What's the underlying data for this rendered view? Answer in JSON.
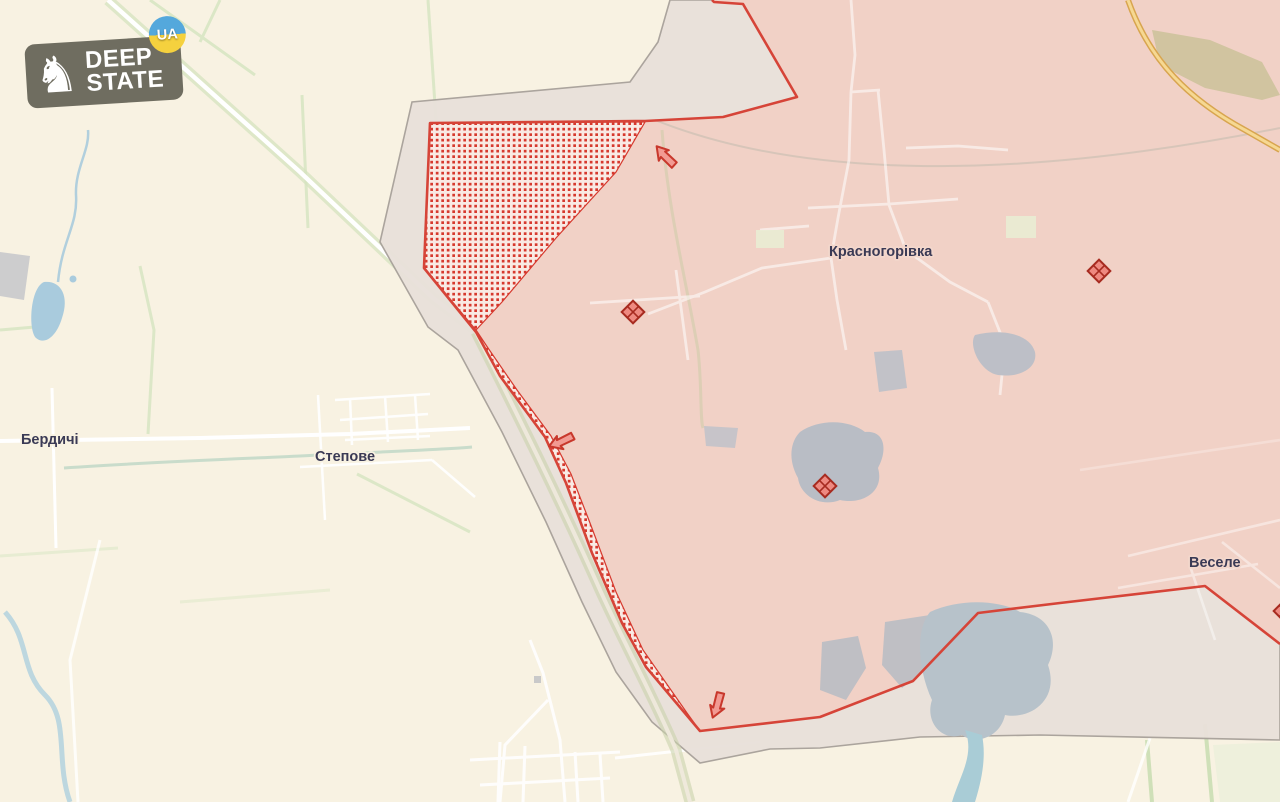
{
  "logo": {
    "line1": "DEEP",
    "line2": "STATE",
    "badge": "UA",
    "knight_icon": "♞"
  },
  "map": {
    "labels": {
      "berdychi": "Бердичі",
      "stepove": "Степове",
      "krasnohorivka": "Красногорівка",
      "vesele": "Веселе"
    },
    "markers": {
      "diamonds": [
        {
          "x": 633,
          "y": 312
        },
        {
          "x": 825,
          "y": 486
        },
        {
          "x": 1099,
          "y": 271
        },
        {
          "x": 1285,
          "y": 611
        }
      ],
      "arrows": [
        {
          "x": 665,
          "y": 157,
          "angle": -38,
          "direction": "northwest"
        },
        {
          "x": 562,
          "y": 442,
          "angle": 252,
          "direction": "west"
        },
        {
          "x": 718,
          "y": 705,
          "angle": 203,
          "direction": "south"
        }
      ]
    },
    "colors": {
      "free_fill": "#f8f2e2",
      "occupied_fill": "#f1d1c6",
      "contested_fill": "#e9e1da",
      "contested_border": "#a9a29b",
      "frontline": "#d64438",
      "advance_dot": "#d6392e",
      "advance_bg": "#f9eae4",
      "water_blue": "#a9cbdd",
      "pond_gray": "#b9bdc5",
      "field_green": "#d8e6c4",
      "road_white": "#ffffff",
      "highway_yellow": "#e8b968",
      "label_text": "#3a3a55",
      "logo_bg": "#6f6d60",
      "badge_blue": "#54a8dc",
      "badge_yellow": "#f5d13e"
    }
  }
}
